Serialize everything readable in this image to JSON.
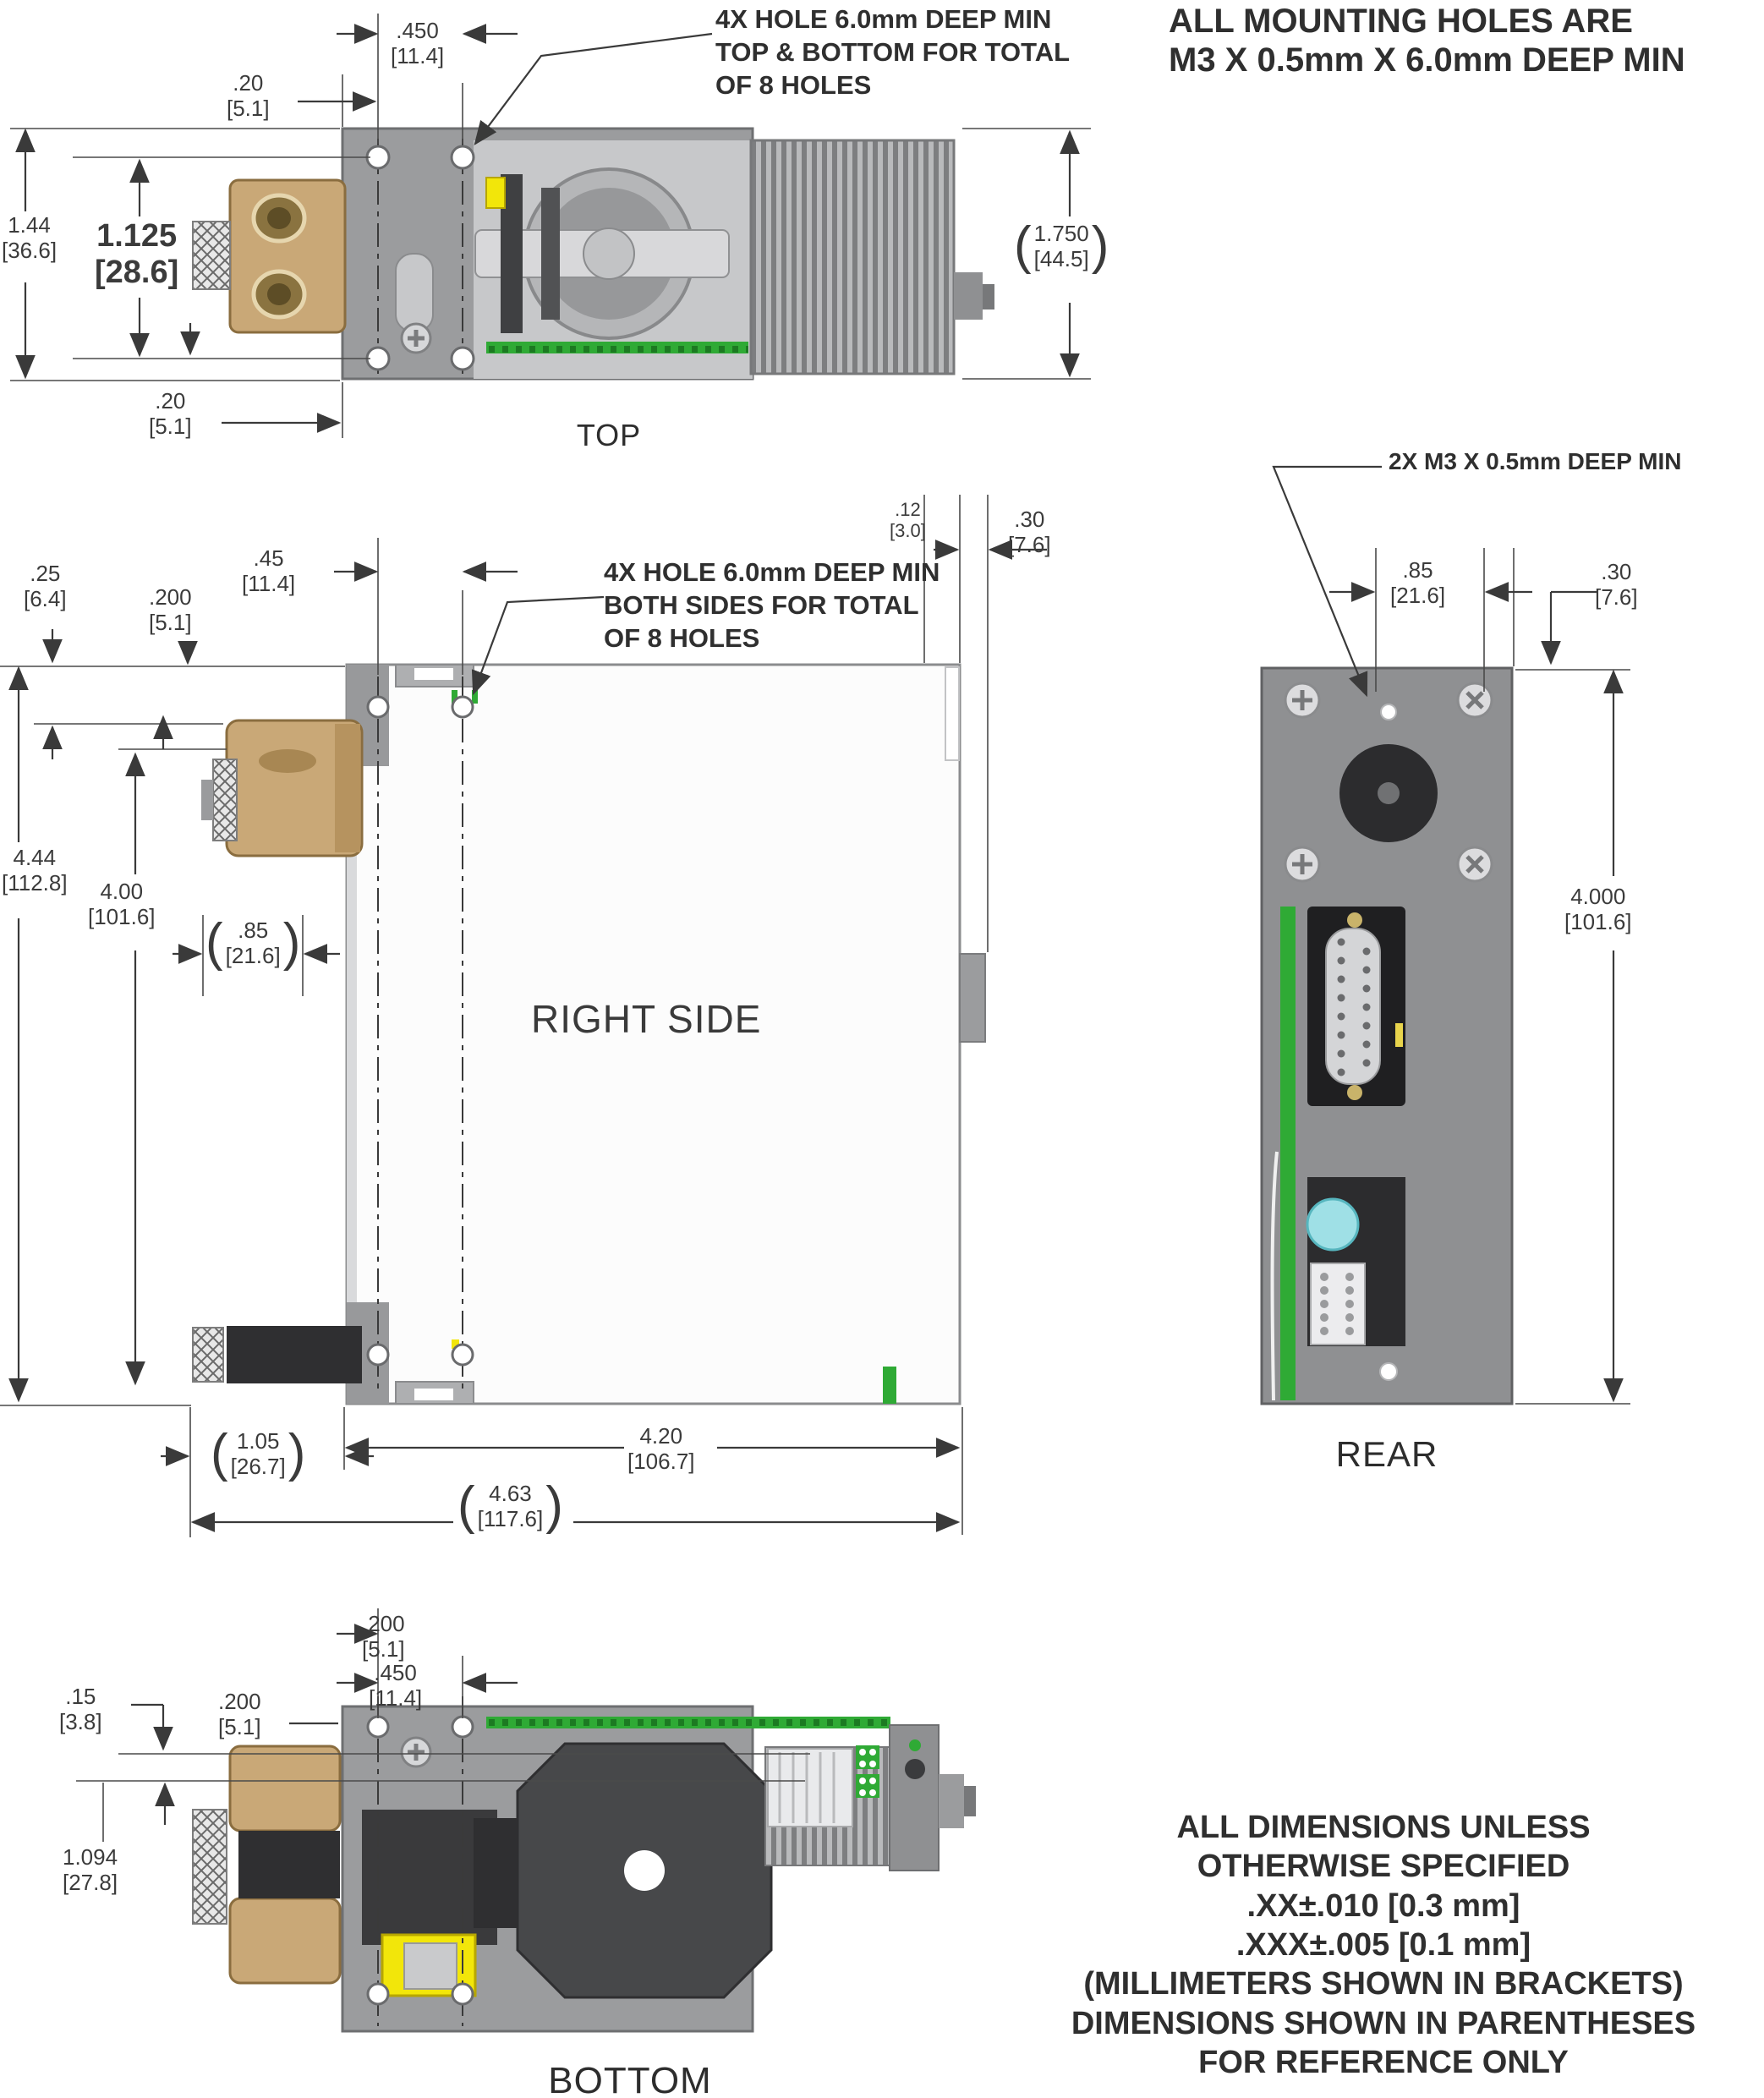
{
  "drawing": {
    "views": {
      "top": {
        "label": "TOP"
      },
      "side": {
        "label": "RIGHT SIDE"
      },
      "rear": {
        "label": "REAR"
      },
      "bottom": {
        "label": "BOTTOM"
      }
    },
    "notes": {
      "mounting": [
        "ALL MOUNTING HOLES ARE",
        "M3 X 0.5mm X 6.0mm DEEP MIN"
      ],
      "top_holes": [
        "4X HOLE 6.0mm DEEP MIN",
        "TOP & BOTTOM FOR TOTAL",
        "OF 8 HOLES"
      ],
      "side_holes": [
        "4X HOLE 6.0mm DEEP MIN",
        "BOTH SIDES FOR TOTAL",
        "OF 8 HOLES"
      ],
      "rear_holes": "2X M3 X 0.5mm DEEP MIN",
      "general": [
        "ALL DIMENSIONS UNLESS",
        "OTHERWISE SPECIFIED",
        ".XX±.010 [0.3 mm]",
        ".XXX±.005 [0.1 mm]",
        "(MILLIMETERS SHOWN IN BRACKETS)",
        "DIMENSIONS SHOWN IN PARENTHESES",
        "FOR REFERENCE ONLY"
      ]
    },
    "dims": {
      "t1": {
        "v": ".20",
        "mm": "[5.1]"
      },
      "t2": {
        "v": ".450",
        "mm": "[11.4]"
      },
      "t3": {
        "v": "1.44",
        "mm": "[36.6]"
      },
      "t4": {
        "v": "1.125",
        "mm": "[28.6]"
      },
      "t5": {
        "v": ".20",
        "mm": "[5.1]"
      },
      "t6": {
        "v": "1.750",
        "mm": "[44.5]",
        "pre": "(",
        "post": ")"
      },
      "s1": {
        "v": ".25",
        "mm": "[6.4]"
      },
      "s2": {
        "v": ".200",
        "mm": "[5.1]"
      },
      "s3": {
        "v": ".45",
        "mm": "[11.4]"
      },
      "s4": {
        "v": ".12",
        "mm": "[3.0]"
      },
      "s5": {
        "v": ".30",
        "mm": "[7.6]"
      },
      "s6": {
        "v": "4.44",
        "mm": "[112.8]"
      },
      "s7": {
        "v": "4.00",
        "mm": "[101.6]"
      },
      "s8": {
        "v": ".85",
        "mm": "[21.6]",
        "pre": "(",
        "post": ")"
      },
      "s9": {
        "v": "1.05",
        "mm": "[26.7]",
        "pre": "(",
        "post": ")"
      },
      "s10": {
        "v": "4.20",
        "mm": "[106.7]"
      },
      "s11": {
        "v": "4.63",
        "mm": "[117.6]",
        "pre": "(",
        "post": ")"
      },
      "r1": {
        "v": ".85",
        "mm": "[21.6]"
      },
      "r2": {
        "v": ".30",
        "mm": "[7.6]"
      },
      "r3": {
        "v": "4.000",
        "mm": "[101.6]"
      },
      "b1": {
        "v": ".15",
        "mm": "[3.8]"
      },
      "b2": {
        "v": ".200",
        "mm": "[5.1]"
      },
      "b3": {
        "v": "1.094",
        "mm": "[27.8]"
      },
      "b4": {
        "v": ".200",
        "mm": "[5.1]"
      },
      "b5": {
        "v": ".450",
        "mm": "[11.4]"
      }
    },
    "colors": {
      "body_gray": "#9b9c9e",
      "brass": "#c9a877",
      "pcb_green": "#2faa35",
      "highlight_yellow": "#f2e60a",
      "component_cyan": "#9fe0e6",
      "line": "#3a3a3a"
    }
  }
}
